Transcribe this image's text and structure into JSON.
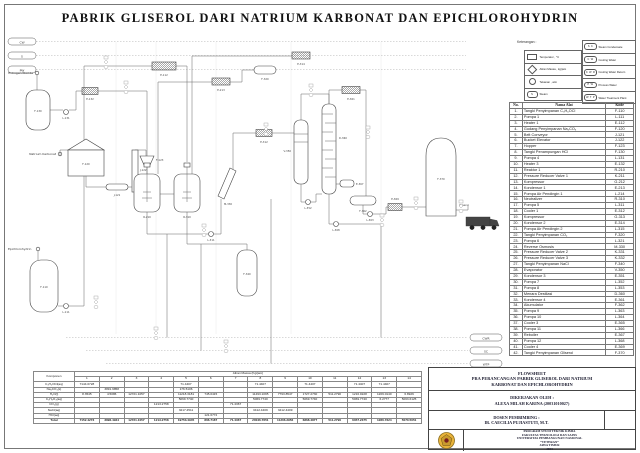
{
  "title": "PABRIK GLISEROL DARI NATRIUM KARBONAT DAN EPICHLOROHYDRIN",
  "legend": {
    "heading": "Keterangan :",
    "left": [
      {
        "shape": "rect-symbol",
        "label": "Temperatur , °C"
      },
      {
        "shape": "diamond-symbol",
        "label": "Aliran Massa , kg/jam"
      },
      {
        "shape": "circle-symbol",
        "label": "Tekanan , atm"
      },
      {
        "shape": "oval-symbol",
        "code": "S",
        "label": "Steam"
      }
    ],
    "right": [
      {
        "code": "S C",
        "label": "Steam Condensate"
      },
      {
        "code": "C W",
        "label": "Cooling Water"
      },
      {
        "code": "C W R",
        "label": "Cooling Water Return"
      },
      {
        "code": "P W",
        "label": "Process Water"
      },
      {
        "code": "W T P",
        "label": "Water Treatment Plant"
      }
    ]
  },
  "equipment_table": {
    "headers": [
      "No.",
      "Nama Alat",
      "Kode"
    ],
    "rows": [
      [
        "1.",
        "Tangki Penyimpanan C₃H₅OCl",
        "F-110"
      ],
      [
        "2.",
        "Pompa 1",
        "L-111"
      ],
      [
        "3.",
        "Heater 1",
        "E-112"
      ],
      [
        "4.",
        "Gudang Penyimpanan Na₂CO₃",
        "F-120"
      ],
      [
        "5.",
        "Belt Conveyor",
        "J-121"
      ],
      [
        "6.",
        "Bucket Elevator",
        "J-122"
      ],
      [
        "7.",
        "Hopper",
        "F-123"
      ],
      [
        "8.",
        "Tangki Penampungan HCl",
        "F-130"
      ],
      [
        "9.",
        "Pompa 4",
        "L-131"
      ],
      [
        "10.",
        "Heater 3",
        "E-132"
      ],
      [
        "11.",
        "Reaktor 1",
        "R-210"
      ],
      [
        "12.",
        "Pressure Reducer Valve 1",
        "K-211"
      ],
      [
        "13.",
        "Kompressor",
        "G-212"
      ],
      [
        "14.",
        "Kondensor 1",
        "E-213"
      ],
      [
        "15.",
        "Pompa Air Pendingin 1",
        "L-214"
      ],
      [
        "16.",
        "Neutralizer",
        "R-310"
      ],
      [
        "17.",
        "Pompa 5",
        "L-311"
      ],
      [
        "18.",
        "Cooler 1",
        "E-312"
      ],
      [
        "19.",
        "Kompressor",
        "G-313"
      ],
      [
        "20.",
        "Kondensor 2",
        "E-314"
      ],
      [
        "21.",
        "Pompa Air Pendingin 2",
        "L-315"
      ],
      [
        "22.",
        "Tangki Penyimpanan CO₂",
        "F-320"
      ],
      [
        "23.",
        "Pompa 6",
        "L-321"
      ],
      [
        "24.",
        "Reverse Osmosis",
        "M-330"
      ],
      [
        "25.",
        "Pressure Reducer Valve 2",
        "K-331"
      ],
      [
        "26.",
        "Pressure Reducer Valve 3",
        "K-332"
      ],
      [
        "27.",
        "Tangki Penyimpanan NaCl",
        "F-340"
      ],
      [
        "28.",
        "Evaporator",
        "V-350"
      ],
      [
        "29.",
        "Kondensor 3",
        "E-351"
      ],
      [
        "30.",
        "Pompa 7",
        "L-352"
      ],
      [
        "31.",
        "Pompa 8",
        "L-353"
      ],
      [
        "32.",
        "Menara Destilasi",
        "D-360"
      ],
      [
        "33.",
        "Kondensor 4",
        "E-361"
      ],
      [
        "34.",
        "Akumulator",
        "F-362"
      ],
      [
        "35.",
        "Pompa 9",
        "L-363"
      ],
      [
        "36.",
        "Pompa 10",
        "L-364"
      ],
      [
        "37.",
        "Cooler 3",
        "E-365"
      ],
      [
        "38.",
        "Pompa 11",
        "L-366"
      ],
      [
        "39.",
        "Reboiler",
        "E-367"
      ],
      [
        "40.",
        "Pompa 12",
        "L-368"
      ],
      [
        "41.",
        "Cooler 4",
        "E-369"
      ],
      [
        "42.",
        "Tangki Penyimpanan Gliserol",
        "F-370"
      ]
    ]
  },
  "mass_table": {
    "header": "Aliran Massa (Kg/jam)",
    "komponen_label": "Komponen",
    "total_label": "Total",
    "streams": [
      "1",
      "2",
      "3",
      "4",
      "5",
      "6",
      "7",
      "8",
      "9",
      "10",
      "11",
      "12",
      "13",
      "14"
    ],
    "rows": [
      {
        "label": "C₃H₅OCl(aq)",
        "values": {
          "1": "7144.0728",
          "5": "71.4407",
          "8": "71.4407",
          "10": "71.4407",
          "12": "71.4407",
          "13": "71.4407"
        }
      },
      {
        "label": "Na₂CO₃(s)",
        "values": {
          "2": "3891.9858",
          "5": "176.5106"
        }
      },
      {
        "label": "H₂O(l)",
        "values": {
          "1": "8.3545",
          "2": "4.5086",
          "3": "12721.1057",
          "5": "11218.3181",
          "6": "745.0415",
          "8": "11493.1095",
          "9": "7793.8547",
          "10": "1727.2730",
          "11": "511.2790",
          "12": "1216.0228",
          "13": "1209.0140",
          "14": "6.8926"
        }
      },
      {
        "label": "C₃H₈O₃(aq)",
        "values": {
          "5": "5069.7740",
          "8": "5069.7740",
          "10": "5069.7740",
          "12": "5069.7740",
          "13": "6.2777",
          "14": "5063.6125"
        }
      },
      {
        "label": "CO₂(g)",
        "values": {
          "4": "1213.2758",
          "7": "71.4367"
        }
      },
      {
        "label": "NaCl(aq)",
        "values": {
          "5": "3217.4511",
          "8": "3412.4409",
          "9": "3412.4409"
        }
      },
      {
        "label": "HCl(aq)",
        "values": {
          "6": "121.6772"
        }
      }
    ],
    "totals": {
      "1": "7152.4273",
      "2": "3896.4944",
      "3": "12721.1057",
      "4": "1213.2758",
      "5": "19753.4945",
      "6": "866.7187",
      "7": "71.4367",
      "8": "20046.7651",
      "9": "11206.2956",
      "10": "6868.4877",
      "11": "511.2790",
      "12": "6357.2375",
      "13": "1286.7324",
      "14": "5070.5051"
    }
  },
  "title_block": {
    "flowsheet_lines": [
      "FLOWSHEET",
      "PRA PERANCANGAN PABRIK GLISEROL DARI NATRIUM",
      "KARBONAT DAN EPICHLOROHYDRIN"
    ],
    "dikerjakan_label": "DIKERJAKAN OLEH :",
    "dikerjakan_name": "ALEXA MILAH KARINA (20031010027)",
    "dosen_label": "DOSEN PEMBIMBING :",
    "dosen_name": "IR. CAECILIA PUJIASTUTI, M.T.",
    "program_lines": [
      "PROGRAM STUDI TEKNIK KIMIA",
      "FAKULTAS TEKNOLOGI DAN SAINS",
      "UNIVERSITAS PEMBANGUNAN NASIONAL",
      "“VETERAN”",
      "JAWA TIMUR",
      "2023"
    ],
    "logo_colors": {
      "disc": "#e8b33a",
      "ring": "#8a6d1f",
      "core": "#7a1f1f"
    }
  },
  "diagram": {
    "utility_pills_left": [
      "CW",
      "S",
      "PW"
    ],
    "utility_pills_right": [
      "CWR",
      "SC",
      "WTP"
    ],
    "inlets": {
      "hcl": "Hidrogen Klorida",
      "na2co3": "Natrium Karbonat",
      "ech": "Epichlorohydrin"
    },
    "outlet": "Gliserol",
    "codes": {
      "f130": "F-130",
      "l131": "L-131",
      "e132": "E-132",
      "f120": "F-120",
      "j121": "J-121",
      "j122": "J-122",
      "f123": "F-123",
      "f110": "F-110",
      "l111": "L-111",
      "e112": "E-112",
      "r210": "R-210",
      "r310": "R-310",
      "e213": "E-213",
      "e314": "E-314",
      "f320": "F-320",
      "m330": "M-330",
      "l311": "L-311",
      "e312": "E-312",
      "v350": "V-350",
      "d360": "D-360",
      "e361": "E-361",
      "e367": "E-367",
      "f362": "F-362",
      "l352": "L-352",
      "l363": "L-363",
      "l368": "L-368",
      "e369": "E-369",
      "f340": "F-340",
      "f370": "F-370"
    }
  }
}
